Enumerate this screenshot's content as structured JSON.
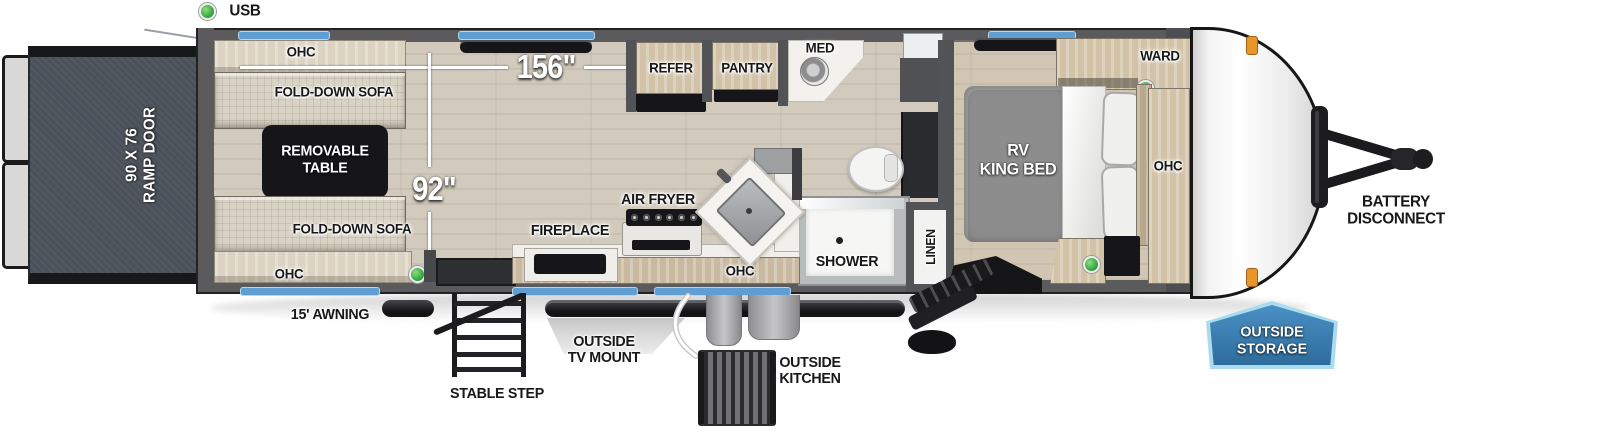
{
  "legend": {
    "usb_label": "USB"
  },
  "dimensions": {
    "length": "156\"",
    "width": "92\""
  },
  "rear": {
    "ramp_door_label": "90 X 76\nRAMP DOOR"
  },
  "garage": {
    "ohc_top_label": "OHC",
    "sofa_top_label": "FOLD-DOWN SOFA",
    "table_label": "REMOVABLE\nTABLE",
    "sofa_bottom_label": "FOLD-DOWN SOFA",
    "ohc_bottom_label": "OHC"
  },
  "kitchen": {
    "refer_label": "REFER",
    "pantry_label": "PANTRY",
    "air_fryer_label": "AIR FRYER",
    "fireplace_label": "FIREPLACE",
    "ohc_label": "OHC"
  },
  "bathroom": {
    "med_label": "MED",
    "shower_label": "SHOWER",
    "linen_label": "LINEN"
  },
  "bedroom": {
    "ward_label": "WARD",
    "bed_label": "RV\nKING BED",
    "ohc_label": "OHC"
  },
  "exterior": {
    "awning_label": "15' AWNING",
    "stable_step_label": "STABLE STEP",
    "tv_mount_label": "OUTSIDE\nTV MOUNT",
    "outside_kitchen_label": "OUTSIDE\nKITCHEN",
    "battery_label": "BATTERY\nDISCONNECT",
    "storage_badge_label": "OUTSIDE\nSTORAGE"
  },
  "colors": {
    "wall_gray": "#5b5b5e",
    "floor_wood": "#d2cabd",
    "window_blue": "#5f9ed2",
    "badge_blue": "#3579ad",
    "badge_border": "#aadcee",
    "usb_green": "#2f9e3a",
    "marker_orange": "#e8952b",
    "ramp_slate": "#4b515a"
  }
}
